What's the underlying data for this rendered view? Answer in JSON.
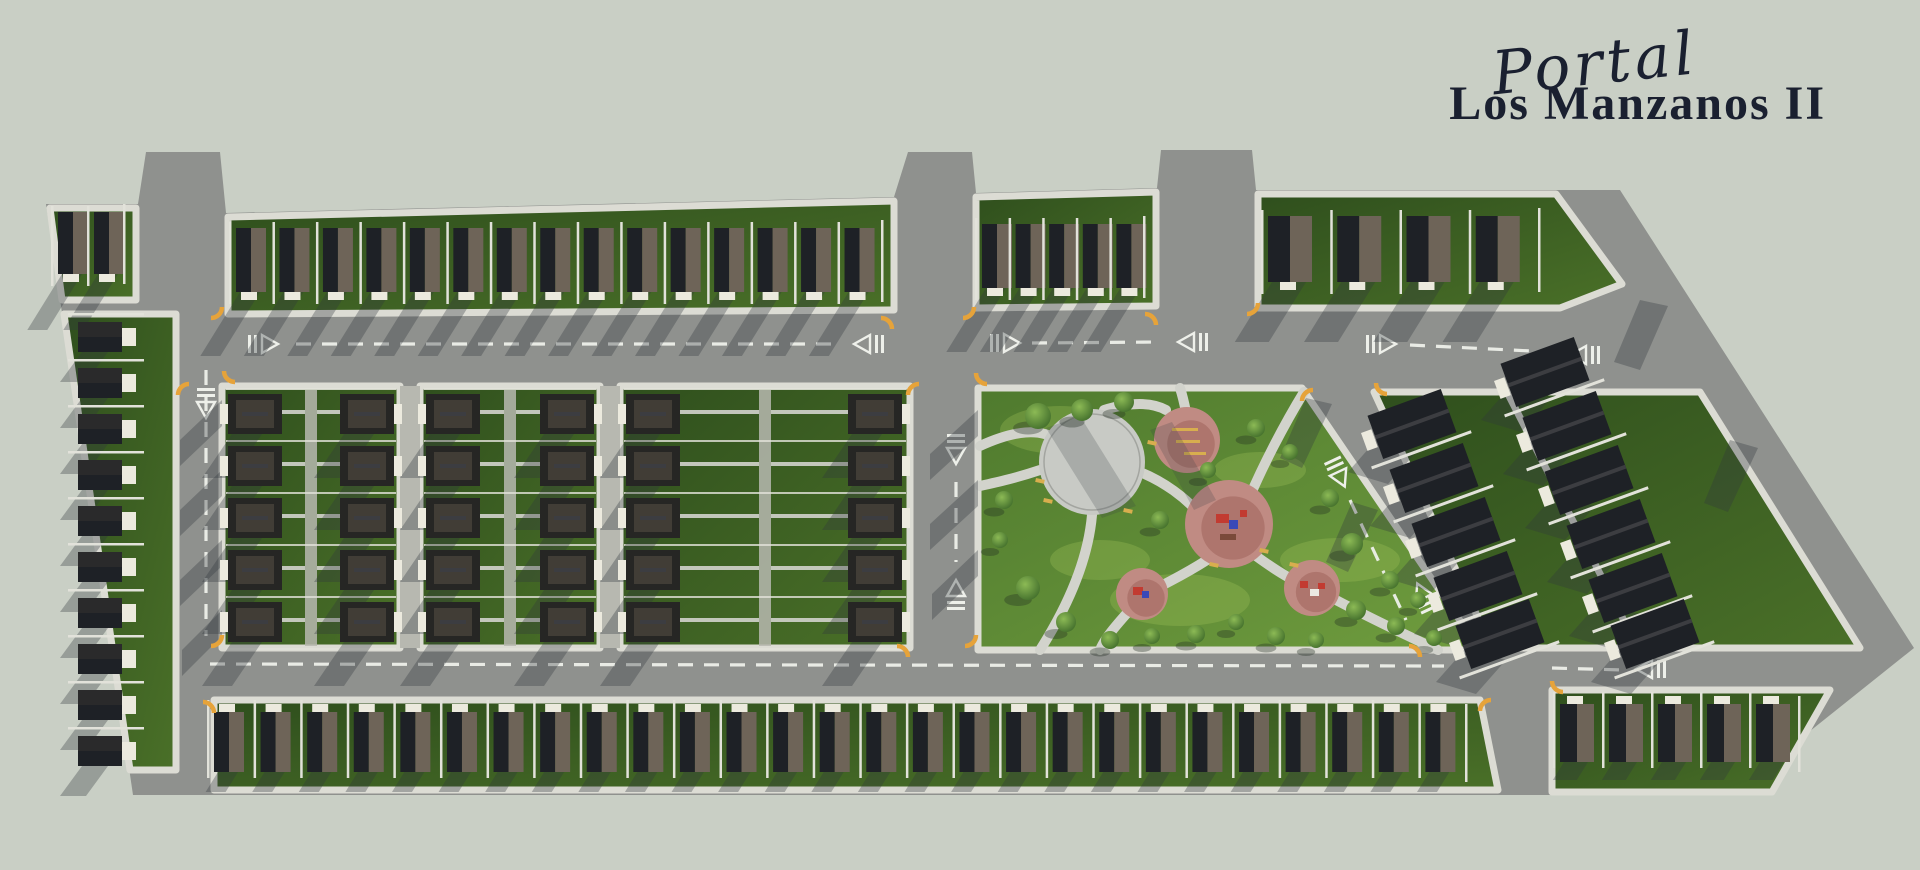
{
  "title": {
    "script_line": "Portal",
    "main_line": "Los Manzanos II"
  },
  "palette": {
    "background": "#c9cfc5",
    "road": "#8f918e",
    "road_shadow": "rgba(48,56,62,0.33)",
    "sidewalk": "#dcdcd4",
    "grass_dark": "#33531f",
    "grass_mid": "#4a7028",
    "park_grass_1": "#4f7a2e",
    "park_grass_2": "#6f9c3e",
    "park_light": "#a9c95e",
    "roof_dark": "#1e2126",
    "roof_light": "#6e6458",
    "roof_hip": "#262624",
    "roof_hip_light": "#413d36",
    "roof_ridge": "#3c3d41",
    "house_white": "#eceade",
    "fence": "#e2e2da",
    "alley": "#b7b8b0",
    "plaza": "#c8cac5",
    "plaza_ring": "#a3a5a0",
    "path": "#d2d3cc",
    "pink": "#c08b83",
    "pink_dark": "#a86e66",
    "tree_light": "#8cba55",
    "tree_dark": "#3f6b2a",
    "bench_yellow": "#d8ae4e",
    "marking_white": "#eef0ea",
    "curb_yellow": "#e6a33a",
    "logo_color": "#1a2030",
    "equip_red": "#c23b31",
    "equip_blue": "#3a49b8"
  },
  "outline": [
    [
      46,
      204
    ],
    [
      138,
      204
    ],
    [
      146,
      152
    ],
    [
      220,
      152
    ],
    [
      226,
      213
    ],
    [
      894,
      197
    ],
    [
      908,
      152
    ],
    [
      972,
      152
    ],
    [
      976,
      193
    ],
    [
      1157,
      188
    ],
    [
      1161,
      150
    ],
    [
      1252,
      150
    ],
    [
      1256,
      190
    ],
    [
      1620,
      190
    ],
    [
      1914,
      648
    ],
    [
      1730,
      795
    ],
    [
      133,
      795
    ]
  ],
  "greens": [
    {
      "name": "block-top-left",
      "pts": [
        [
          50,
          208
        ],
        [
          136,
          208
        ],
        [
          136,
          300
        ],
        [
          62,
          300
        ]
      ]
    },
    {
      "name": "block-top-row-west",
      "pts": [
        [
          228,
          217
        ],
        [
          894,
          201
        ],
        [
          894,
          310
        ],
        [
          228,
          314
        ]
      ]
    },
    {
      "name": "block-top-row-mid",
      "pts": [
        [
          976,
          197
        ],
        [
          1156,
          192
        ],
        [
          1156,
          306
        ],
        [
          976,
          308
        ]
      ]
    },
    {
      "name": "block-top-right",
      "pts": [
        [
          1258,
          194
        ],
        [
          1556,
          194
        ],
        [
          1622,
          284
        ],
        [
          1560,
          308
        ],
        [
          1258,
          308
        ]
      ]
    },
    {
      "name": "block-west-column",
      "pts": [
        [
          64,
          314
        ],
        [
          176,
          314
        ],
        [
          176,
          770
        ],
        [
          130,
          770
        ]
      ]
    },
    {
      "name": "block-mid-1",
      "pts": [
        [
          222,
          386
        ],
        [
          400,
          386
        ],
        [
          400,
          648
        ],
        [
          222,
          648
        ]
      ]
    },
    {
      "name": "block-mid-2",
      "pts": [
        [
          420,
          386
        ],
        [
          600,
          386
        ],
        [
          600,
          648
        ],
        [
          420,
          648
        ]
      ]
    },
    {
      "name": "block-mid-3",
      "pts": [
        [
          620,
          386
        ],
        [
          910,
          386
        ],
        [
          910,
          648
        ],
        [
          620,
          648
        ]
      ]
    },
    {
      "name": "central-park",
      "pts": [
        [
          978,
          388
        ],
        [
          1302,
          388
        ],
        [
          1480,
          650
        ],
        [
          978,
          650
        ]
      ],
      "park": true
    },
    {
      "name": "block-east-diagonal",
      "pts": [
        [
          1374,
          392
        ],
        [
          1700,
          392
        ],
        [
          1860,
          648
        ],
        [
          1492,
          648
        ]
      ]
    },
    {
      "name": "block-bottom-row-west",
      "pts": [
        [
          214,
          700
        ],
        [
          1480,
          700
        ],
        [
          1498,
          790
        ],
        [
          214,
          790
        ]
      ]
    },
    {
      "name": "block-bottom-row-east",
      "pts": [
        [
          1552,
          690
        ],
        [
          1830,
          690
        ],
        [
          1772,
          792
        ],
        [
          1552,
          792
        ]
      ]
    }
  ],
  "alleys": [
    [
      400,
      386,
      20,
      262
    ],
    [
      600,
      386,
      20,
      262
    ]
  ],
  "house_rows": [
    {
      "name": "row-top-left",
      "y": 212,
      "h": 62,
      "w": 30,
      "x0": 58,
      "x1": 130,
      "count": 2,
      "porch": "s",
      "shadow": 56
    },
    {
      "name": "row-top-west",
      "y": 228,
      "h": 64,
      "w": 30,
      "x0": 236,
      "x1": 888,
      "count": 15,
      "porch": "s",
      "shadow": 64
    },
    {
      "name": "row-top-mid",
      "y": 224,
      "h": 64,
      "w": 30,
      "x0": 982,
      "x1": 1150,
      "count": 5,
      "porch": "s",
      "shadow": 64
    },
    {
      "name": "row-top-right",
      "y": 216,
      "h": 66,
      "w": 44,
      "x0": 1268,
      "x1": 1545,
      "count": 4,
      "porch": "s",
      "shadow": 60
    },
    {
      "name": "row-bottom-west",
      "y": 712,
      "h": 60,
      "w": 30,
      "x0": 214,
      "x1": 1472,
      "count": 27,
      "porch": "n",
      "shadow": 20
    },
    {
      "name": "row-bottom-east",
      "y": 704,
      "h": 58,
      "w": 34,
      "x0": 1560,
      "x1": 1805,
      "count": 5,
      "porch": "n",
      "shadow": 18
    }
  ],
  "west_column": {
    "x": 78,
    "w": 44,
    "h": 30,
    "porch_w": 14,
    "y0": 322,
    "step": 46,
    "count": 10
  },
  "mid_blocks": [
    {
      "x0": 222,
      "x1": 400,
      "col_left": 228,
      "col_right": 340
    },
    {
      "x0": 420,
      "x1": 600,
      "col_left": 426,
      "col_right": 540
    },
    {
      "x0": 620,
      "x1": 910,
      "col_left": 626,
      "col_right": 848
    }
  ],
  "mid_rows": {
    "y0": 394,
    "step": 52,
    "count": 5,
    "house_w": 54,
    "house_h": 40
  },
  "diag_block": {
    "angle": -20,
    "house_w": 78,
    "house_h": 46,
    "houses": [
      [
        1412,
        424
      ],
      [
        1434,
        478
      ],
      [
        1456,
        532
      ],
      [
        1478,
        586
      ],
      [
        1500,
        634
      ],
      [
        1545,
        372
      ],
      [
        1567,
        426
      ],
      [
        1589,
        480
      ],
      [
        1611,
        534
      ],
      [
        1633,
        588
      ],
      [
        1655,
        634
      ]
    ],
    "walkway": "M 1508,394 L 1638,648"
  },
  "park": {
    "plaza": {
      "cx": 1092,
      "cy": 462,
      "r": 53
    },
    "pink_circles": [
      {
        "name": "exercise-area",
        "cx": 1187,
        "cy": 440,
        "r": 33
      },
      {
        "name": "playground-main",
        "cx": 1229,
        "cy": 524,
        "r": 44
      },
      {
        "name": "playground-small",
        "cx": 1142,
        "cy": 594,
        "r": 26
      },
      {
        "name": "picnic-area",
        "cx": 1312,
        "cy": 588,
        "r": 28
      }
    ],
    "paths": [
      "M 980,446 C 1015,430 1040,428 1058,440",
      "M 1092,515 C 1088,560 1068,606 1040,650",
      "M 1140,472 C 1165,482 1185,498 1198,512",
      "M 1256,556 C 1278,572 1292,580 1302,584",
      "M 1336,600 C 1374,620 1408,636 1438,650",
      "M 1207,560 C 1185,574 1172,580 1163,585",
      "M 1128,612 C 1112,630 1104,640 1100,650",
      "M 1186,412 C 1184,402 1182,394 1180,388",
      "M 1304,392 C 1282,428 1262,468 1250,496",
      "M 1104,410 C 1130,402 1152,402 1166,410",
      "M 1040,470 C 1016,478 998,482 980,486"
    ],
    "trees": [
      [
        1038,
        416,
        13
      ],
      [
        1082,
        410,
        11
      ],
      [
        1124,
        402,
        10
      ],
      [
        1004,
        500,
        9
      ],
      [
        1000,
        540,
        8
      ],
      [
        1028,
        588,
        12
      ],
      [
        1066,
        622,
        10
      ],
      [
        1110,
        640,
        9
      ],
      [
        1152,
        636,
        8
      ],
      [
        1196,
        634,
        9
      ],
      [
        1236,
        622,
        8
      ],
      [
        1276,
        636,
        9
      ],
      [
        1316,
        640,
        8
      ],
      [
        1356,
        610,
        10
      ],
      [
        1396,
        626,
        9
      ],
      [
        1434,
        638,
        8
      ],
      [
        1352,
        544,
        11
      ],
      [
        1390,
        580,
        9
      ],
      [
        1160,
        520,
        9
      ],
      [
        1208,
        470,
        8
      ],
      [
        1256,
        428,
        9
      ],
      [
        1290,
        452,
        8
      ],
      [
        1330,
        498,
        9
      ],
      [
        1418,
        600,
        8
      ]
    ],
    "benches": [
      [
        1044,
        498
      ],
      [
        1036,
        478
      ],
      [
        1124,
        508
      ],
      [
        1148,
        440
      ],
      [
        1210,
        562
      ],
      [
        1260,
        548
      ],
      [
        1290,
        562
      ]
    ],
    "light_patches": [
      [
        1060,
        430,
        60,
        24
      ],
      [
        1180,
        600,
        70,
        26
      ],
      [
        1340,
        560,
        60,
        22
      ],
      [
        1100,
        560,
        50,
        20
      ],
      [
        1260,
        470,
        46,
        18
      ]
    ],
    "equipment": {
      "playground-main": [
        [
          "#c23b31",
          1216,
          514,
          13,
          9
        ],
        [
          "#3a49b8",
          1229,
          520,
          9,
          9
        ],
        [
          "#c23b31",
          1240,
          510,
          7,
          7
        ],
        [
          "#7a4a3a",
          1220,
          534,
          16,
          6
        ]
      ],
      "playground-small": [
        [
          "#c23b31",
          1133,
          587,
          10,
          8
        ],
        [
          "#3a49b8",
          1142,
          591,
          7,
          7
        ]
      ],
      "picnic-area": [
        [
          "#c23b31",
          1300,
          581,
          8,
          7
        ],
        [
          "#ece9e2",
          1310,
          589,
          9,
          7
        ],
        [
          "#c23b31",
          1318,
          583,
          7,
          6
        ]
      ],
      "exercise-area": [
        [
          "#d8ae4e",
          1172,
          428,
          26,
          3
        ],
        [
          "#d8ae4e",
          1176,
          440,
          24,
          3
        ],
        [
          "#d8ae4e",
          1184,
          452,
          22,
          3
        ]
      ]
    },
    "shadow_bands": [
      [
        [
          1046,
          428
        ],
        [
          1080,
          416
        ],
        [
          1136,
          506
        ],
        [
          1102,
          518
        ]
      ],
      [
        [
          1150,
          430
        ],
        [
          1172,
          422
        ],
        [
          1216,
          500
        ],
        [
          1194,
          510
        ]
      ]
    ]
  },
  "markings": {
    "dashes": [
      "M 296,344 L 838,344",
      "M 1032,343 L 1162,342",
      "M 1410,345 L 1552,352",
      "M 210,664 L 1444,666",
      "M 1552,668 L 1624,670",
      "M 206,370 L 206,636",
      "M 956,482 L 956,562",
      "M 1350,500 L 1406,620"
    ],
    "yields": [
      [
        262,
        344,
        0
      ],
      [
        870,
        344,
        180
      ],
      [
        1004,
        343,
        0
      ],
      [
        1194,
        342,
        180
      ],
      [
        1380,
        344,
        0
      ],
      [
        1586,
        355,
        180
      ],
      [
        206,
        402,
        90
      ],
      [
        956,
        448,
        90
      ],
      [
        956,
        596,
        270
      ],
      [
        1338,
        472,
        65
      ],
      [
        1424,
        598,
        245
      ],
      [
        1652,
        669,
        180
      ]
    ]
  },
  "road_shadow_polys": [
    [
      [
        222,
        400
      ],
      [
        222,
        426
      ],
      [
        180,
        466
      ],
      [
        180,
        440
      ]
    ],
    [
      [
        222,
        470
      ],
      [
        222,
        496
      ],
      [
        180,
        536
      ],
      [
        180,
        510
      ]
    ],
    [
      [
        222,
        540
      ],
      [
        222,
        566
      ],
      [
        180,
        606
      ],
      [
        180,
        580
      ]
    ],
    [
      [
        222,
        610
      ],
      [
        222,
        636
      ],
      [
        182,
        676
      ],
      [
        182,
        650
      ]
    ],
    [
      [
        978,
        410
      ],
      [
        978,
        436
      ],
      [
        930,
        480
      ],
      [
        930,
        454
      ]
    ],
    [
      [
        978,
        480
      ],
      [
        978,
        506
      ],
      [
        930,
        550
      ],
      [
        930,
        524
      ]
    ],
    [
      [
        978,
        550
      ],
      [
        978,
        576
      ],
      [
        932,
        620
      ],
      [
        932,
        594
      ]
    ],
    [
      [
        1306,
        398
      ],
      [
        1332,
        404
      ],
      [
        1302,
        468
      ],
      [
        1280,
        458
      ]
    ],
    [
      [
        1352,
        502
      ],
      [
        1378,
        510
      ],
      [
        1348,
        572
      ],
      [
        1326,
        562
      ]
    ],
    [
      [
        1640,
        300
      ],
      [
        1668,
        306
      ],
      [
        1640,
        370
      ],
      [
        1614,
        362
      ]
    ],
    [
      [
        1730,
        440
      ],
      [
        1758,
        448
      ],
      [
        1728,
        512
      ],
      [
        1704,
        503
      ]
    ]
  ],
  "curb_accents": [
    [
      222,
      318,
      90
    ],
    [
      224,
      382,
      180
    ],
    [
      892,
      318,
      0
    ],
    [
      908,
      384,
      270
    ],
    [
      974,
      318,
      90
    ],
    [
      976,
      384,
      180
    ],
    [
      1156,
      314,
      0
    ],
    [
      1258,
      314,
      90
    ],
    [
      1302,
      390,
      270
    ],
    [
      1376,
      394,
      180
    ],
    [
      178,
      384,
      270
    ],
    [
      222,
      646,
      90
    ],
    [
      908,
      646,
      0
    ],
    [
      976,
      646,
      90
    ],
    [
      1420,
      646,
      0
    ],
    [
      1552,
      692,
      180
    ],
    [
      1480,
      700,
      270
    ],
    [
      214,
      702,
      0
    ]
  ]
}
